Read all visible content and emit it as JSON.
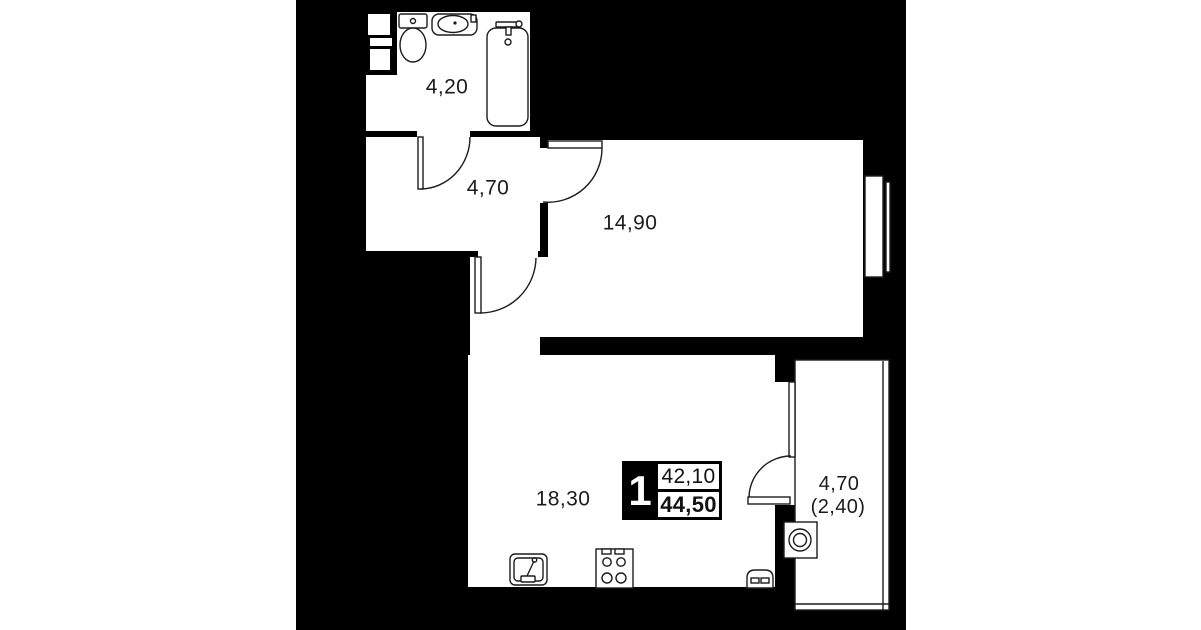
{
  "page": {
    "background_color": "#ffffff",
    "wall_color": "#000000",
    "floor_color": "#ffffff",
    "line_color": "#1c1c1c"
  },
  "plan": {
    "rooms": [
      {
        "name": "bathroom",
        "area": "4,20"
      },
      {
        "name": "hallway",
        "area": "4,70"
      },
      {
        "name": "living-room",
        "area": "14,90"
      },
      {
        "name": "kitchen-living-room",
        "area": "18,30"
      },
      {
        "name": "balcony",
        "area": "4,70",
        "area_reduced": "(2,40)"
      }
    ],
    "legend": {
      "rooms_count": "1",
      "living_area": "42,10",
      "total_area": "44,50"
    },
    "fixtures": [
      "toilet-icon",
      "bathroom-sink-icon",
      "bathtub-icon",
      "kitchen-sink-icon",
      "stove-icon",
      "oven-icon",
      "washing-machine-icon"
    ]
  }
}
